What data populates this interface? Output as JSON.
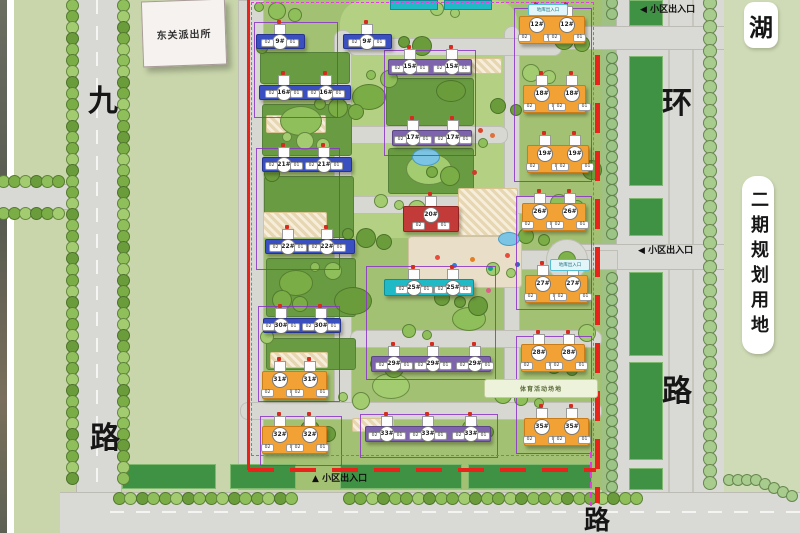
{
  "map": {
    "police_station": "东关派出所",
    "lake_label": "湖",
    "west_road": {
      "char1": "九",
      "char2": "路"
    },
    "east_road": {
      "char1": "环",
      "char2": "路"
    },
    "bottom_road_label": "路",
    "phase2_label": "二期规划用地",
    "sports_field_label": "体育活动场地",
    "garage_entrance_label": "地库出入口",
    "entrances": [
      {
        "id": "north",
        "arrow": "◀",
        "text": "小区出入口"
      },
      {
        "id": "east",
        "arrow": "◀",
        "text": "小区出入口"
      },
      {
        "id": "south",
        "arrow": "▲",
        "text": "小区出入口"
      }
    ],
    "unit_labels": [
      "02",
      "01"
    ]
  },
  "palette": {
    "blue": "#3a4fc0",
    "blue_dark": "#26348f",
    "purple": "#7e63ad",
    "purple_dark": "#5d4687",
    "teal": "#1fbac6",
    "teal_dark": "#118d98",
    "orange": "#f2a234",
    "orange_dark": "#c97c18",
    "red": "#c23b38",
    "red_dark": "#8f2420",
    "boundary_red": "#e8231b",
    "boundary_magenta": "#e23ce2",
    "cluster_violet": "#8b32c8"
  },
  "buildings": [
    {
      "label": "9#",
      "style": "blue",
      "x": 256,
      "y": 34,
      "w": 47,
      "h": 13,
      "badges": [
        279
      ]
    },
    {
      "label": "9#",
      "style": "blue",
      "x": 343,
      "y": 34,
      "w": 47,
      "h": 13,
      "badges": [
        366
      ]
    },
    {
      "label": "16#",
      "style": "blue",
      "x": 259,
      "y": 85,
      "w": 90,
      "h": 13,
      "badges": [
        283,
        325
      ]
    },
    {
      "label": "21#",
      "style": "blue",
      "x": 262,
      "y": 157,
      "w": 88,
      "h": 13,
      "badges": [
        283,
        323
      ]
    },
    {
      "label": "22#",
      "style": "blue",
      "x": 265,
      "y": 239,
      "w": 88,
      "h": 13,
      "badges": [
        287,
        326
      ]
    },
    {
      "label": "30#",
      "style": "blue",
      "x": 263,
      "y": 318,
      "w": 76,
      "h": 13,
      "badges": [
        280,
        320
      ]
    },
    {
      "label": "15#",
      "style": "purple",
      "x": 388,
      "y": 59,
      "w": 82,
      "h": 14,
      "badges": [
        409,
        451
      ]
    },
    {
      "label": "17#",
      "style": "purple",
      "x": 392,
      "y": 130,
      "w": 78,
      "h": 14,
      "badges": [
        412,
        452
      ]
    },
    {
      "label": "20#",
      "style": "red",
      "x": 403,
      "y": 206,
      "w": 54,
      "h": 24,
      "badges": [
        430
      ]
    },
    {
      "label": "25#",
      "style": "teal",
      "x": 384,
      "y": 279,
      "w": 88,
      "h": 15,
      "badges": [
        413,
        452
      ]
    },
    {
      "label": "29#",
      "style": "purple",
      "x": 371,
      "y": 356,
      "w": 118,
      "h": 14,
      "badges": [
        393,
        432,
        474
      ]
    },
    {
      "label": "33#",
      "style": "purple",
      "x": 365,
      "y": 426,
      "w": 124,
      "h": 14,
      "badges": [
        386,
        427,
        470
      ]
    },
    {
      "label": "12#",
      "style": "orange",
      "x": 519,
      "y": 16,
      "w": 64,
      "h": 26,
      "badges": [
        536,
        566
      ]
    },
    {
      "label": "18#",
      "style": "orange",
      "x": 523,
      "y": 85,
      "w": 61,
      "h": 26,
      "badges": [
        541,
        571
      ]
    },
    {
      "label": "19#",
      "style": "orange",
      "x": 527,
      "y": 145,
      "w": 60,
      "h": 26,
      "badges": [
        544,
        574
      ]
    },
    {
      "label": "26#",
      "style": "orange",
      "x": 522,
      "y": 203,
      "w": 62,
      "h": 26,
      "badges": [
        539,
        569
      ]
    },
    {
      "label": "27#",
      "style": "orange",
      "x": 525,
      "y": 275,
      "w": 61,
      "h": 26,
      "badges": [
        542,
        572
      ]
    },
    {
      "label": "28#",
      "style": "orange",
      "x": 521,
      "y": 344,
      "w": 62,
      "h": 26,
      "badges": [
        538,
        568
      ]
    },
    {
      "label": "35#",
      "style": "orange",
      "x": 524,
      "y": 418,
      "w": 63,
      "h": 26,
      "badges": [
        541,
        571
      ]
    },
    {
      "label": "31#",
      "style": "orange",
      "x": 262,
      "y": 371,
      "w": 63,
      "h": 26,
      "badges": [
        279,
        309
      ]
    },
    {
      "label": "32#",
      "style": "orange",
      "x": 262,
      "y": 426,
      "w": 63,
      "h": 26,
      "badges": [
        279,
        309
      ]
    }
  ]
}
